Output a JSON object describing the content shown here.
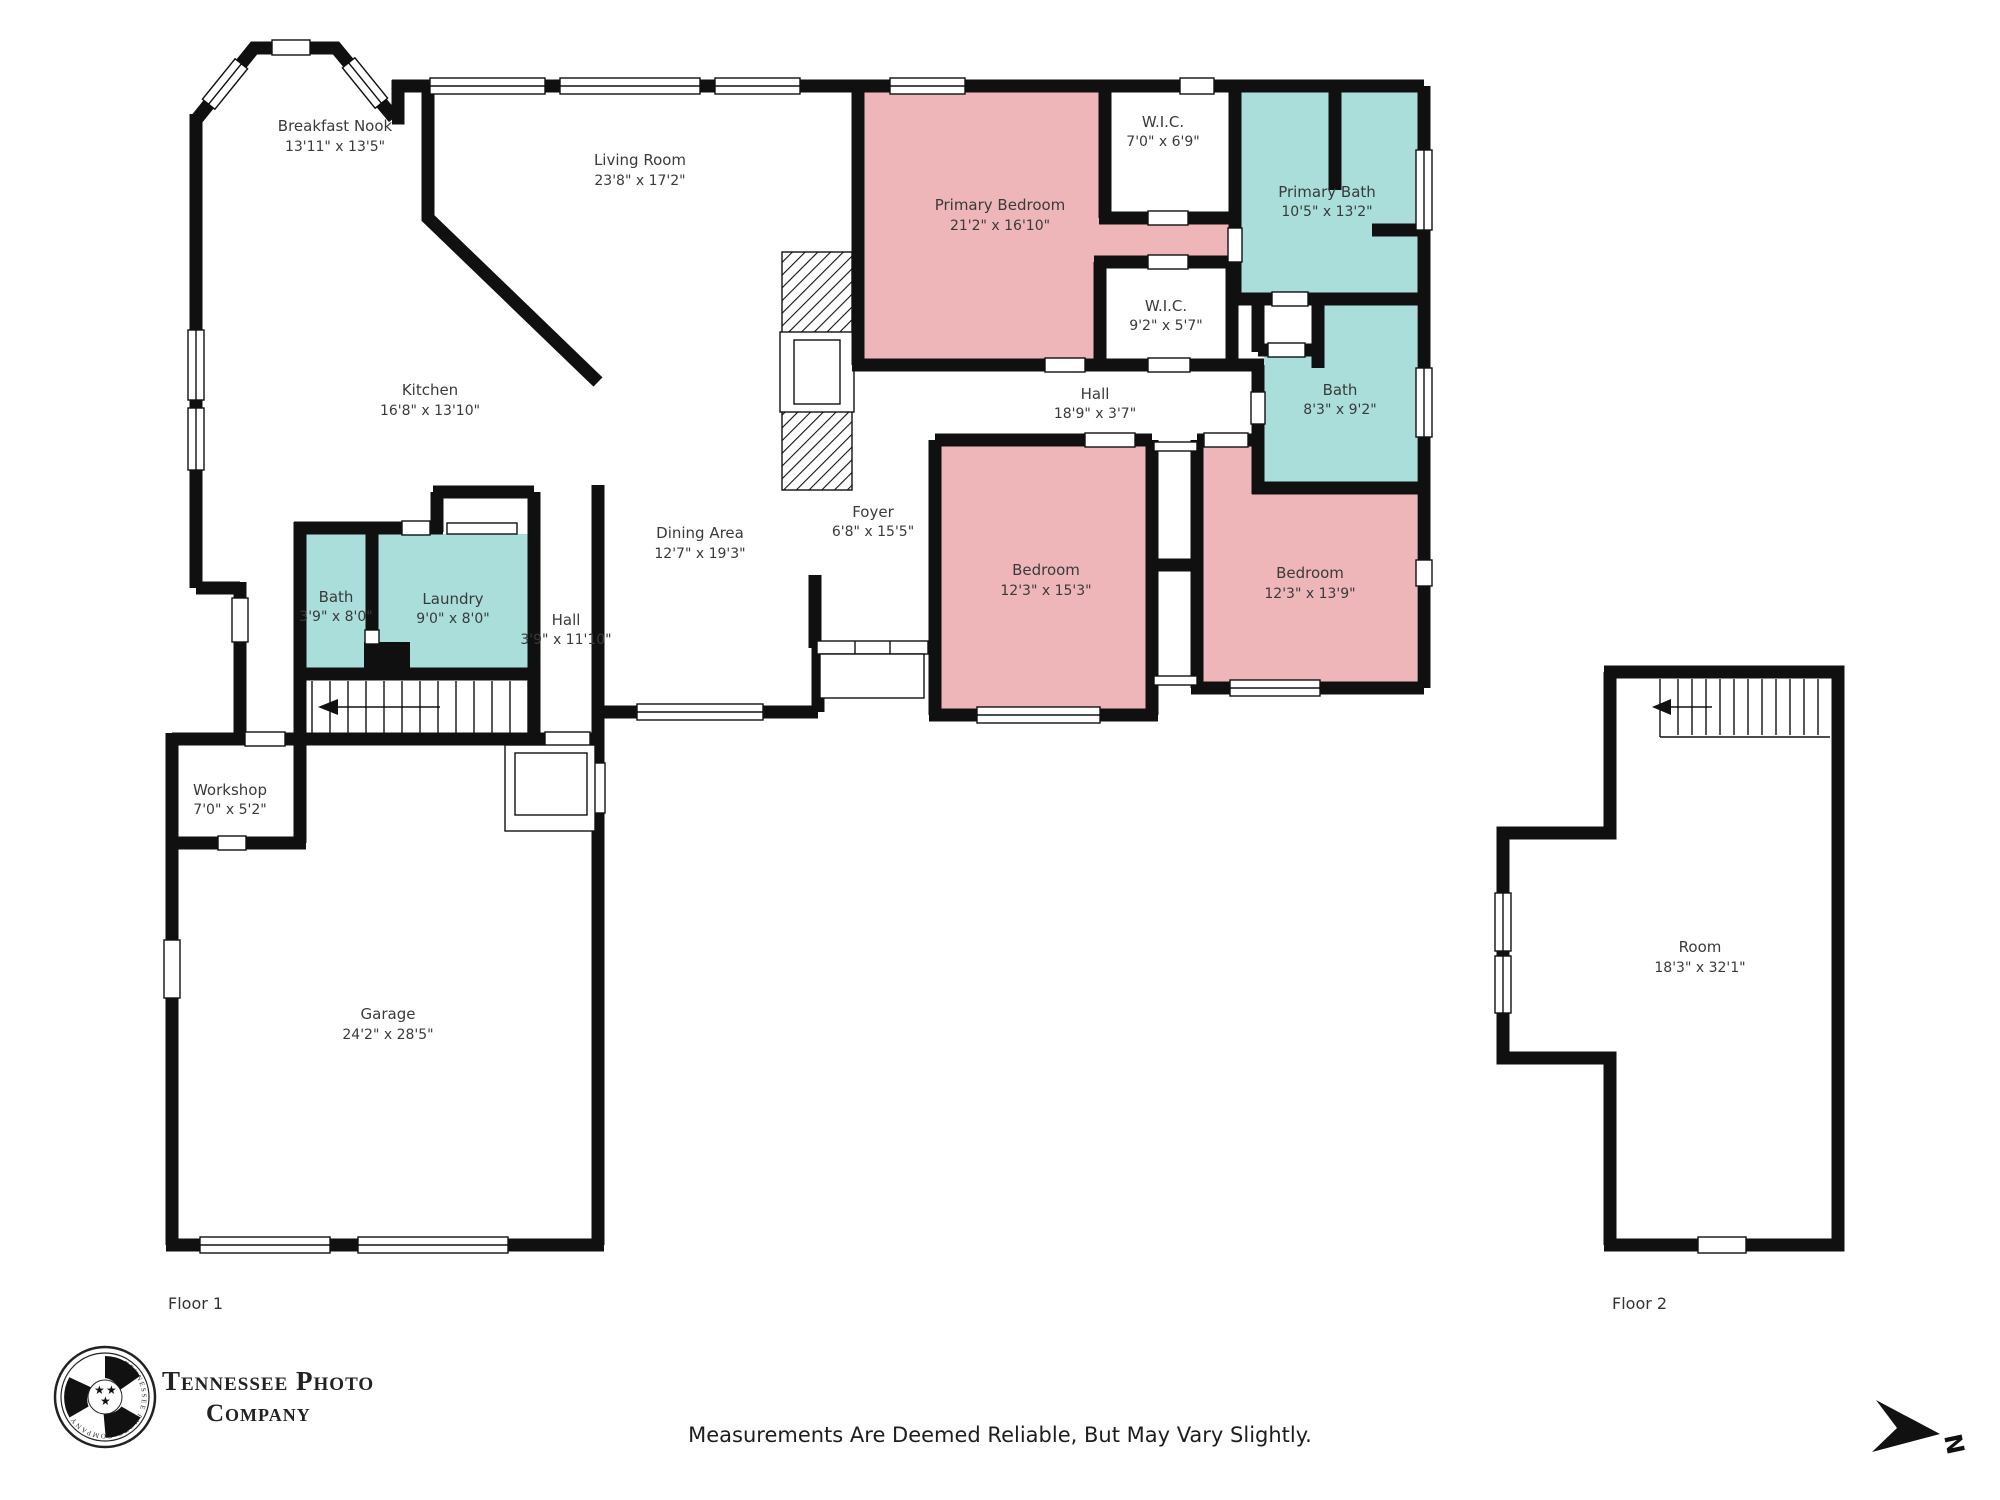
{
  "floor1": {
    "label": "Floor 1",
    "rooms": [
      {
        "name": "Breakfast Nook",
        "dims": "13'11\" x 13'5\""
      },
      {
        "name": "Living Room",
        "dims": "23'8\" x 17'2\""
      },
      {
        "name": "Primary Bedroom",
        "dims": "21'2\" x 16'10\""
      },
      {
        "name": "W.I.C.",
        "dims": "7'0\" x 6'9\""
      },
      {
        "name": "Primary Bath",
        "dims": "10'5\" x 13'2\""
      },
      {
        "name": "W.I.C.",
        "dims": "9'2\" x 5'7\""
      },
      {
        "name": "Hall",
        "dims": "18'9\" x 3'7\""
      },
      {
        "name": "Bath",
        "dims": "8'3\" x 9'2\""
      },
      {
        "name": "Kitchen",
        "dims": "16'8\" x 13'10\""
      },
      {
        "name": "Dining Area",
        "dims": "12'7\" x 19'3\""
      },
      {
        "name": "Foyer",
        "dims": "6'8\" x 15'5\""
      },
      {
        "name": "Bedroom",
        "dims": "12'3\" x 15'3\""
      },
      {
        "name": "Bedroom",
        "dims": "12'3\" x 13'9\""
      },
      {
        "name": "Bath",
        "dims": "3'9\" x 8'0\""
      },
      {
        "name": "Laundry",
        "dims": "9'0\" x 8'0\""
      },
      {
        "name": "Hall",
        "dims": "3'9\" x 11'10\""
      },
      {
        "name": "Workshop",
        "dims": "7'0\" x 5'2\""
      },
      {
        "name": "Garage",
        "dims": "24'2\" x 28'5\""
      }
    ]
  },
  "floor2": {
    "label": "Floor 2",
    "rooms": [
      {
        "name": "Room",
        "dims": "18'3\" x 32'1\""
      }
    ]
  },
  "footer": {
    "disclaimer": "Measurements Are Deemed Reliable, But May Vary Slightly."
  },
  "logo": {
    "line1": "Tennessee Photo",
    "line2": "Company",
    "ring_text": "TENNESSEE PHOTO COMPANY"
  },
  "compass": {
    "label": "N"
  },
  "colors": {
    "bedroom": "#efb6ba",
    "bath": "#a9dedb",
    "wall": "#101010",
    "background": "#ffffff"
  }
}
